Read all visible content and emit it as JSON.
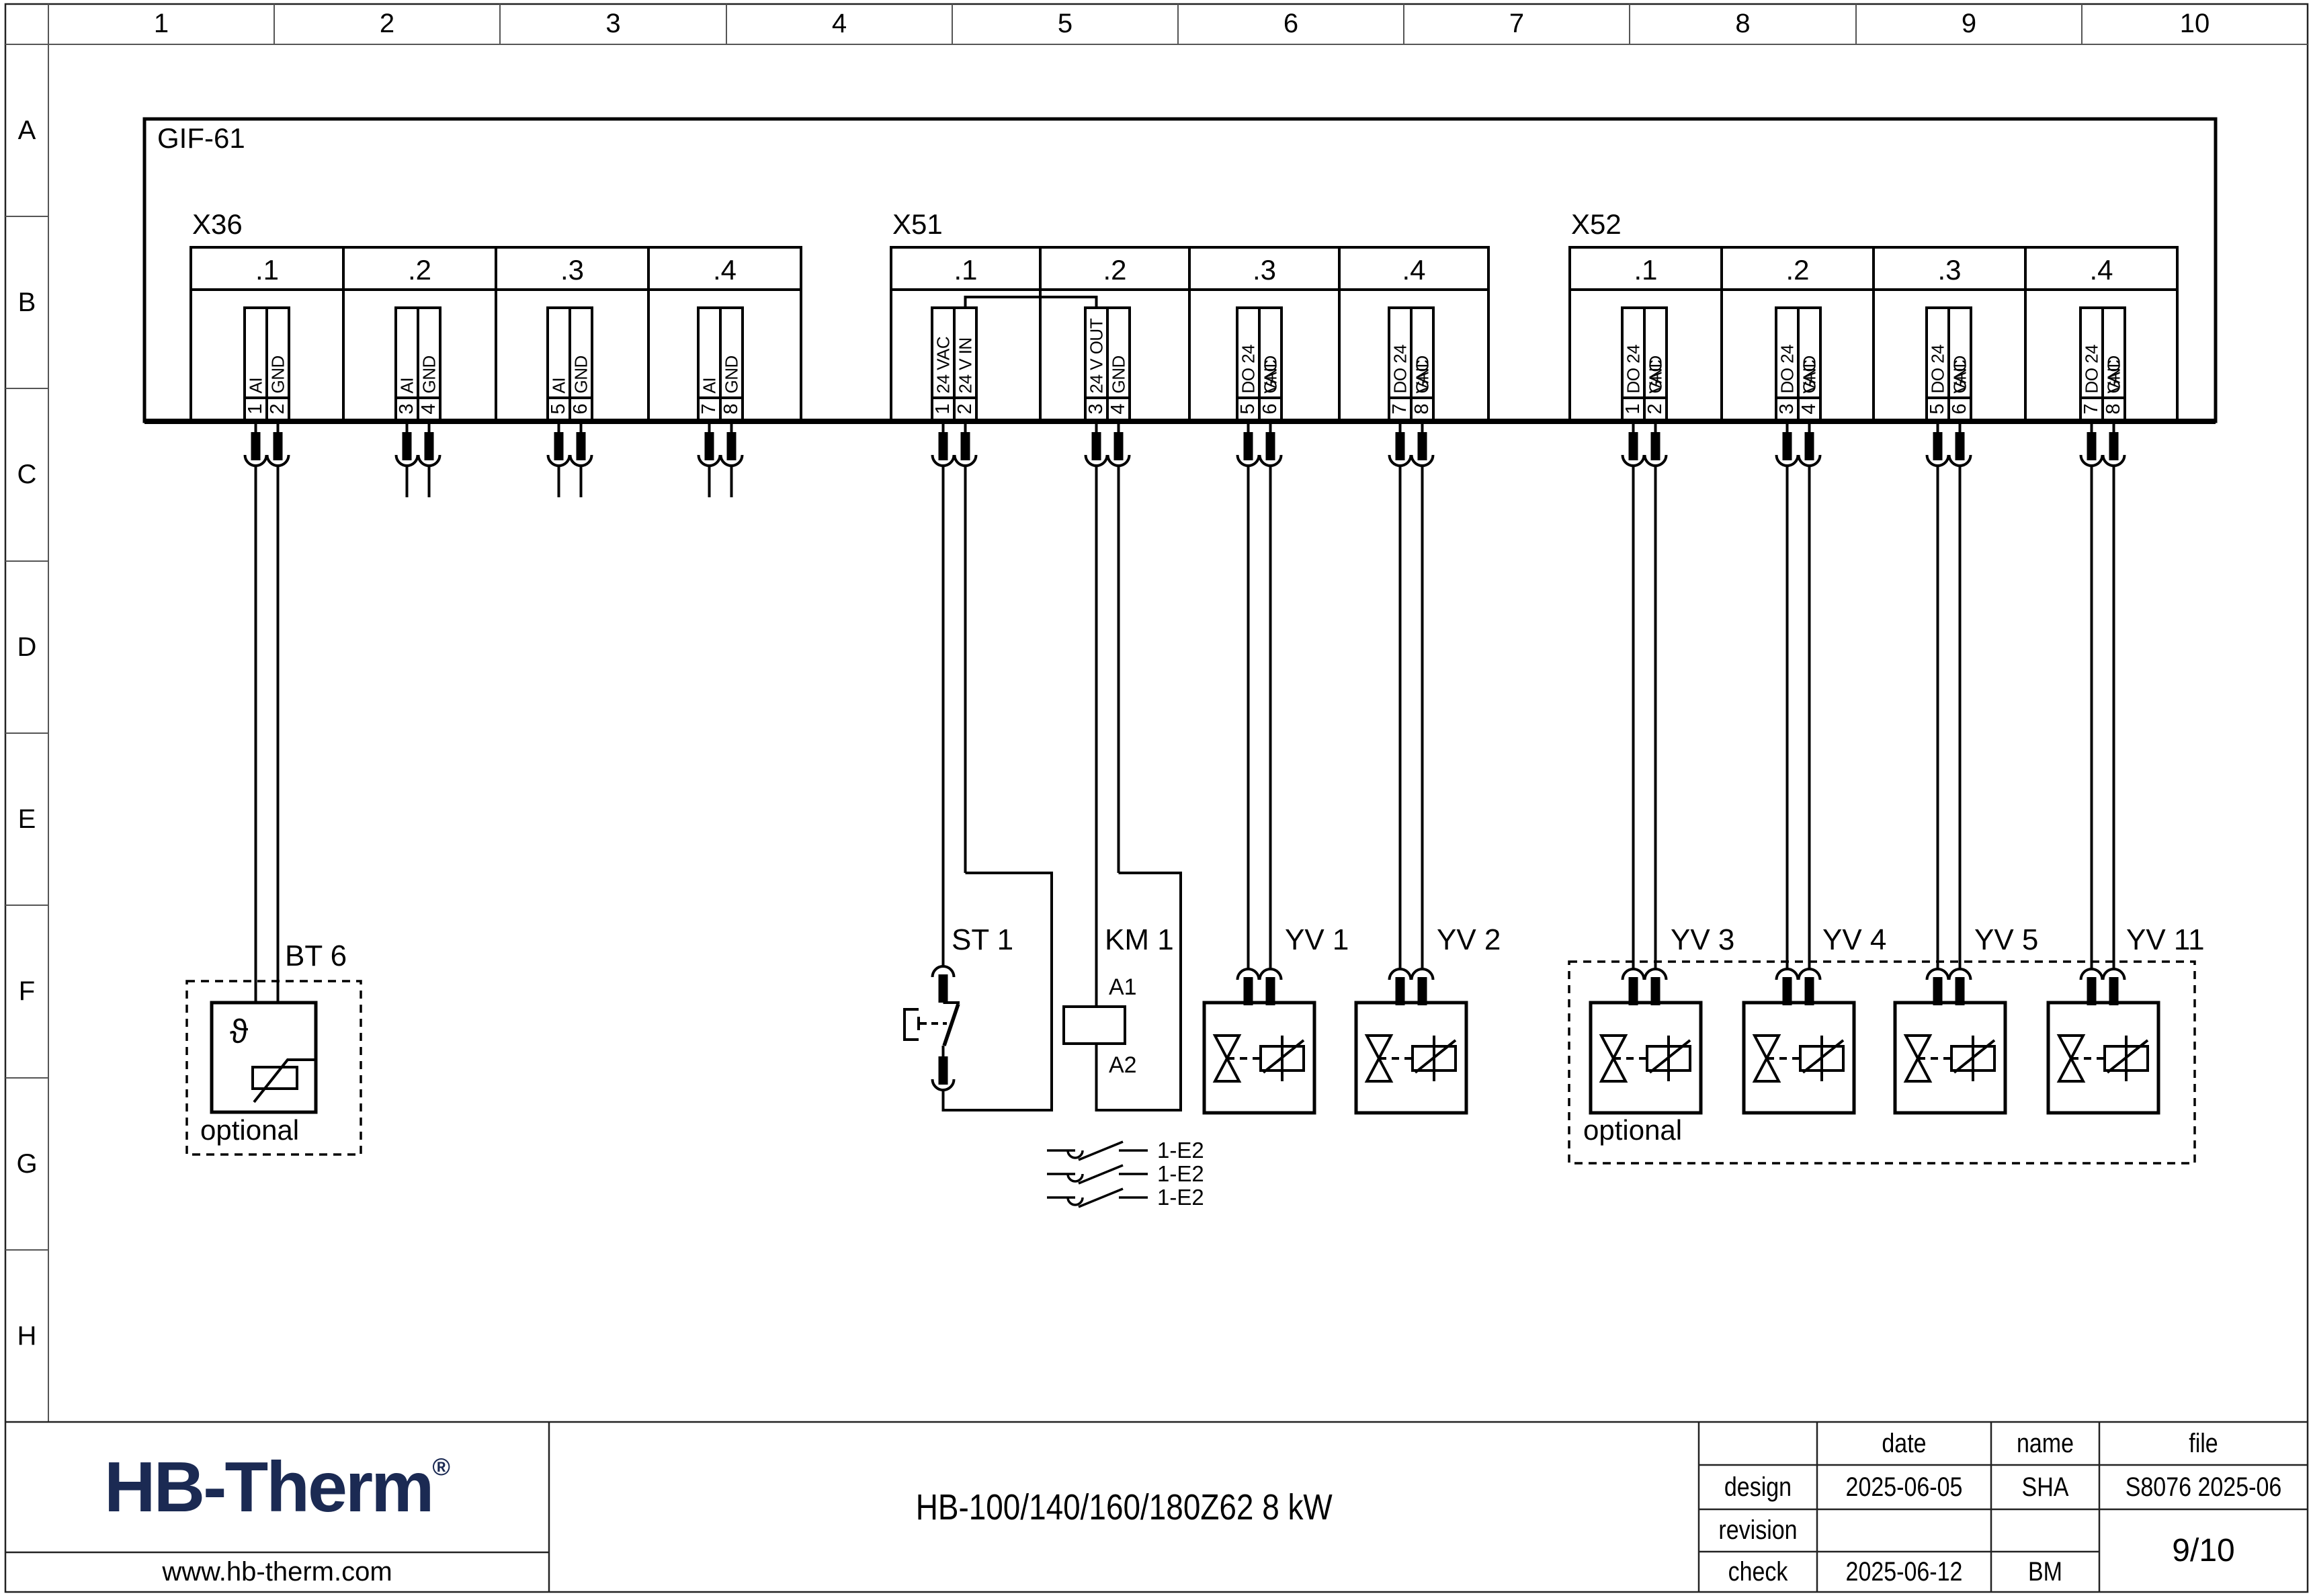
{
  "grid": {
    "columns": [
      "1",
      "2",
      "3",
      "4",
      "5",
      "6",
      "7",
      "8",
      "9",
      "10"
    ],
    "rows": [
      "A",
      "B",
      "C",
      "D",
      "E",
      "F",
      "G",
      "H"
    ]
  },
  "device": {
    "label": "GIF-61"
  },
  "blocks": [
    {
      "label": "X36",
      "sections": [
        {
          "label": ".1",
          "terminals": [
            {
              "pin": "1",
              "label": "AI"
            },
            {
              "pin": "2",
              "label": "GND"
            }
          ]
        },
        {
          "label": ".2",
          "terminals": [
            {
              "pin": "3",
              "label": "AI"
            },
            {
              "pin": "4",
              "label": "GND"
            }
          ]
        },
        {
          "label": ".3",
          "terminals": [
            {
              "pin": "5",
              "label": "AI"
            },
            {
              "pin": "6",
              "label": "GND"
            }
          ]
        },
        {
          "label": ".4",
          "terminals": [
            {
              "pin": "7",
              "label": "AI"
            },
            {
              "pin": "8",
              "label": "GND"
            }
          ]
        }
      ]
    },
    {
      "label": "X51",
      "sections": [
        {
          "label": ".1",
          "terminals": [
            {
              "pin": "1",
              "label": "24 VAC"
            },
            {
              "pin": "2",
              "label": "24 V IN"
            }
          ]
        },
        {
          "label": ".2",
          "terminals": [
            {
              "pin": "3",
              "label": "24 V OUT"
            },
            {
              "pin": "4",
              "label": "GND"
            }
          ]
        },
        {
          "label": ".3",
          "terminals": [
            {
              "pin": "5",
              "label": "DO 24 VAC"
            },
            {
              "pin": "6",
              "label": "GND"
            }
          ]
        },
        {
          "label": ".4",
          "terminals": [
            {
              "pin": "7",
              "label": "DO 24 VAC"
            },
            {
              "pin": "8",
              "label": "GND"
            }
          ]
        }
      ]
    },
    {
      "label": "X52",
      "sections": [
        {
          "label": ".1",
          "terminals": [
            {
              "pin": "1",
              "label": "DO 24 VAC"
            },
            {
              "pin": "2",
              "label": "GND"
            }
          ]
        },
        {
          "label": ".2",
          "terminals": [
            {
              "pin": "3",
              "label": "DO 24 VAC"
            },
            {
              "pin": "4",
              "label": "GND"
            }
          ]
        },
        {
          "label": ".3",
          "terminals": [
            {
              "pin": "5",
              "label": "DO 24 VAC"
            },
            {
              "pin": "6",
              "label": "GND"
            }
          ]
        },
        {
          "label": ".4",
          "terminals": [
            {
              "pin": "7",
              "label": "DO 24 VAC"
            },
            {
              "pin": "8",
              "label": "GND"
            }
          ]
        }
      ]
    }
  ],
  "components": {
    "bt6": {
      "label": "BT 6",
      "symbol": "ϑ",
      "note": "optional"
    },
    "st1": {
      "label": "ST 1"
    },
    "km1": {
      "label": "KM 1",
      "a1": "A1",
      "a2": "A2"
    },
    "valves": [
      {
        "label": "YV 1"
      },
      {
        "label": "YV 2"
      },
      {
        "label": "YV 3"
      },
      {
        "label": "YV 4"
      },
      {
        "label": "YV 5"
      },
      {
        "label": "YV 11"
      }
    ],
    "contact_refs": [
      "1-E2",
      "1-E2",
      "1-E2"
    ],
    "optional_note": "optional"
  },
  "title_block": {
    "logo": "HB-Therm",
    "logo_reg": "®",
    "website": "www.hb-therm.com",
    "title": "HB-100/140/160/180Z62 8 kW",
    "table": {
      "headers": {
        "date": "date",
        "name": "name",
        "file": "file"
      },
      "rows": [
        {
          "label": "design",
          "date": "2025-06-05",
          "name": "SHA",
          "file": "S8076 2025-06"
        },
        {
          "label": "revision",
          "date": "",
          "name": ""
        },
        {
          "label": "check",
          "date": "2025-06-12",
          "name": "BM"
        }
      ],
      "page": "9/10"
    },
    "colors": {
      "logo": "#1b2a53",
      "line": "#000000"
    }
  }
}
